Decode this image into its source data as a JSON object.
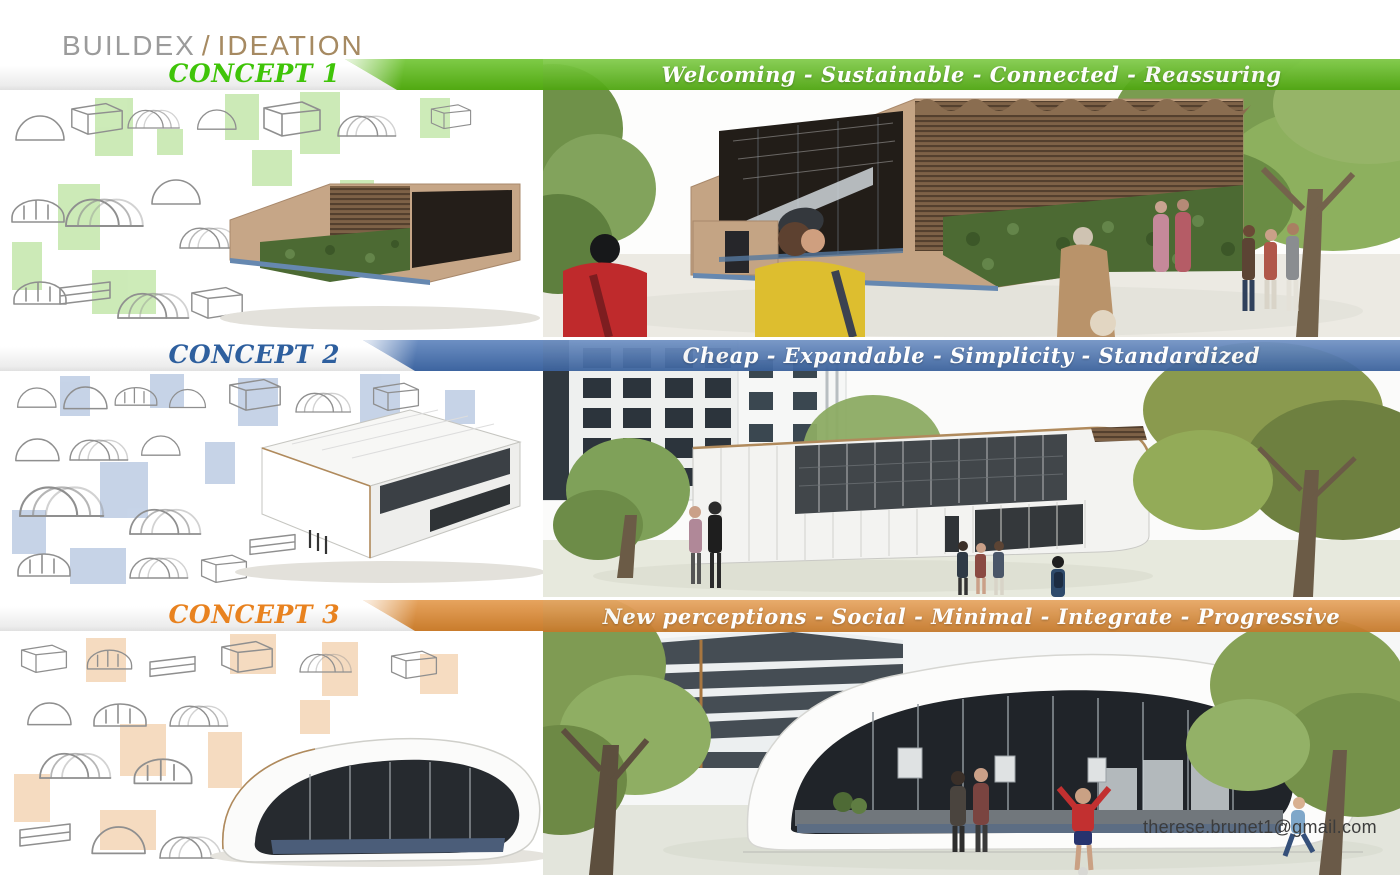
{
  "header": {
    "brand": "BUILDEX",
    "separator": "/",
    "project": "IDEATION"
  },
  "concepts": [
    {
      "label": "CONCEPT 1",
      "keywords": "Welcoming - Sustainable - Connected - Reassuring",
      "accent": "#5abc13",
      "label_color": "#3fc408"
    },
    {
      "label": "CONCEPT 2",
      "keywords": "Cheap - Expandable - Simplicity - Standardized",
      "accent": "#4470b2",
      "label_color": "#2e5f9e"
    },
    {
      "label": "CONCEPT 3",
      "keywords": "New perceptions - Social - Minimal - Integrate - Progressive",
      "accent": "#e08a31",
      "label_color": "#e8821f"
    }
  ],
  "contact": {
    "email": "therese.brunet1@gmail.com"
  }
}
